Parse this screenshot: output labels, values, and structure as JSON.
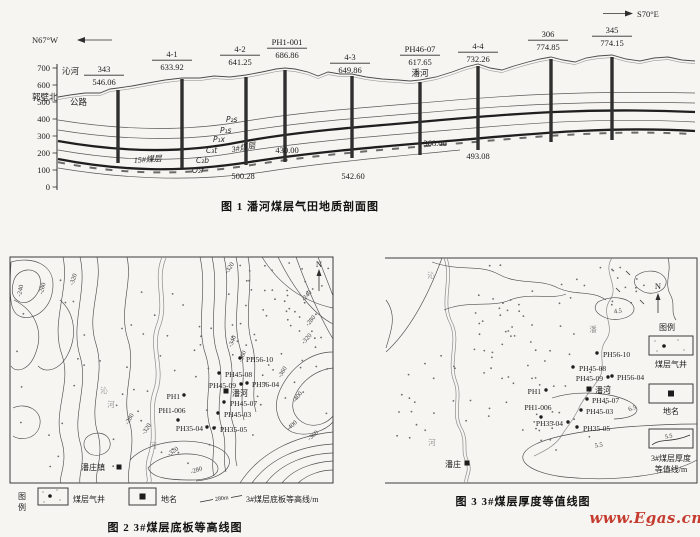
{
  "watermark": {
    "text": "www.Egas.cn",
    "color": "#c53b2f"
  },
  "fig1": {
    "caption": "图 1  潘河煤层气田地质剖面图",
    "dir_left": "N67°W",
    "dir_right": "S70°E",
    "yticks": [
      {
        "t": "700",
        "y": 68
      },
      {
        "t": "600",
        "y": 85
      },
      {
        "t": "500",
        "y": 102
      },
      {
        "t": "400",
        "y": 119
      },
      {
        "t": "300",
        "y": 136
      },
      {
        "t": "200",
        "y": 153
      },
      {
        "t": "100",
        "y": 170
      },
      {
        "t": "0",
        "y": 187
      }
    ],
    "surface_labels": [
      {
        "t": "沁河",
        "x": 62,
        "y": 74
      },
      {
        "t": "郭壁北",
        "x": 32,
        "y": 100
      },
      {
        "t": "公路",
        "x": 70,
        "y": 105
      }
    ],
    "wells": [
      {
        "name": "343",
        "elev": "546.06",
        "x": 118,
        "top": 90,
        "bot": 163,
        "lx": 104,
        "ly": 72
      },
      {
        "name": "4-1",
        "elev": "633.92",
        "x": 182,
        "top": 79,
        "bot": 168,
        "lx": 172,
        "ly": 57
      },
      {
        "name": "4-2",
        "elev": "641.25",
        "x": 246,
        "top": 77,
        "bot": 165,
        "lx": 240,
        "ly": 52
      },
      {
        "name": "PH1-001",
        "elev": "686.86",
        "x": 285,
        "top": 70,
        "bot": 162,
        "lx": 287,
        "ly": 45
      },
      {
        "name": "4-3",
        "elev": "649.86",
        "x": 352,
        "top": 76,
        "bot": 158,
        "lx": 350,
        "ly": 60
      },
      {
        "name": "PH46-07",
        "elev": "617.65",
        "x": 420,
        "top": 82,
        "bot": 155,
        "lx": 420,
        "ly": 52,
        "sub": "潘河"
      },
      {
        "name": "4-4",
        "elev": "732.26",
        "x": 478,
        "top": 66,
        "bot": 150,
        "lx": 478,
        "ly": 49
      },
      {
        "name": "306",
        "elev": "774.85",
        "x": 551,
        "top": 59,
        "bot": 142,
        "lx": 548,
        "ly": 37
      },
      {
        "name": "345",
        "elev": "774.15",
        "x": 612,
        "top": 57,
        "bot": 140,
        "lx": 612,
        "ly": 33
      }
    ],
    "strat_labels": [
      {
        "t": "P₂s",
        "x": 226,
        "y": 122
      },
      {
        "t": "P₁s",
        "x": 220,
        "y": 133
      },
      {
        "t": "P₁x",
        "x": 213,
        "y": 142
      },
      {
        "t": "C₃t",
        "x": 206,
        "y": 153
      },
      {
        "t": "C₂b",
        "x": 196,
        "y": 163
      },
      {
        "t": "O₂f",
        "x": 192,
        "y": 173
      }
    ],
    "coal_labels": [
      {
        "t": "3#煤层",
        "x": 244,
        "y": 150,
        "r": -10
      },
      {
        "t": "15#煤层",
        "x": 148,
        "y": 162,
        "r": -4
      }
    ],
    "depths": [
      {
        "t": "500.28",
        "x": 243,
        "y": 179
      },
      {
        "t": "430.00",
        "x": 287,
        "y": 153
      },
      {
        "t": "542.60",
        "x": 353,
        "y": 179
      },
      {
        "t": "368.00",
        "x": 435,
        "y": 146
      },
      {
        "t": "493.08",
        "x": 478,
        "y": 159
      }
    ]
  },
  "fig2": {
    "caption": "图 2  3#煤层底板等高线图",
    "north": "N",
    "legend": {
      "t1": "图",
      "t2": "例",
      "well": "煤层气井",
      "place": "地名",
      "sym": "280m",
      "contour": "3#煤层底板等高线/m"
    },
    "contour_labels": [
      {
        "t": "-240",
        "x": 22,
        "y": 291,
        "r": -78
      },
      {
        "t": "-280",
        "x": 44,
        "y": 289,
        "r": -75
      },
      {
        "t": "-320",
        "x": 75,
        "y": 280,
        "r": -72
      },
      {
        "t": "-320",
        "x": 231,
        "y": 269,
        "r": -55
      },
      {
        "t": "-240",
        "x": 308,
        "y": 297,
        "r": -48
      },
      {
        "t": "-280",
        "x": 312,
        "y": 322,
        "r": -50
      },
      {
        "t": "-320",
        "x": 308,
        "y": 340,
        "r": -48
      },
      {
        "t": "-340",
        "x": 234,
        "y": 342,
        "r": -68
      },
      {
        "t": "-360",
        "x": 244,
        "y": 357,
        "r": -70
      },
      {
        "t": "-360",
        "x": 284,
        "y": 373,
        "r": -58
      },
      {
        "t": "-400",
        "x": 299,
        "y": 398,
        "r": -52
      },
      {
        "t": "-400",
        "x": 293,
        "y": 427,
        "r": -42
      },
      {
        "t": "-360",
        "x": 314,
        "y": 437,
        "r": -40
      },
      {
        "t": "-320",
        "x": 174,
        "y": 453,
        "r": -35
      },
      {
        "t": "-280",
        "x": 197,
        "y": 472,
        "r": -18
      },
      {
        "t": "-280",
        "x": 131,
        "y": 420,
        "r": -60
      },
      {
        "t": "-320",
        "x": 148,
        "y": 430,
        "r": -55
      }
    ],
    "wells": [
      {
        "name": "PH56-10",
        "dx": 240,
        "dy": 358,
        "lx": 246,
        "ly": 362,
        "a": "start"
      },
      {
        "name": "PH45-08",
        "dx": 219,
        "dy": 373,
        "lx": 225,
        "ly": 377,
        "a": "start"
      },
      {
        "name": "PH45-09",
        "dx": 241,
        "dy": 384,
        "lx": 236,
        "ly": 388,
        "a": "end"
      },
      {
        "name": "PH56-04",
        "dx": 247,
        "dy": 383,
        "lx": 252,
        "ly": 387,
        "a": "start"
      },
      {
        "name": "PH45-07",
        "dx": 224,
        "dy": 402,
        "lx": 230,
        "ly": 406,
        "a": "start"
      },
      {
        "name": "PH45-03",
        "dx": 218,
        "dy": 413,
        "lx": 224,
        "ly": 417,
        "a": "start"
      },
      {
        "name": "PH35-04",
        "dx": 207,
        "dy": 427,
        "lx": 203,
        "ly": 431,
        "a": "end"
      },
      {
        "name": "PH35-05",
        "dx": 214,
        "dy": 428,
        "lx": 220,
        "ly": 432,
        "a": "start"
      },
      {
        "name": "PH1",
        "dx": 184,
        "dy": 395,
        "lx": 180,
        "ly": 399,
        "a": "end"
      },
      {
        "name": "PH1-006",
        "dx": 178,
        "dy": 420,
        "lx": 172,
        "ly": 413,
        "a": "middle"
      }
    ],
    "towns": [
      {
        "t": "潘河",
        "x": 232,
        "y": 396,
        "sq": [
          226,
          391
        ],
        "a": "start"
      },
      {
        "t": "潘庄镇",
        "x": 81,
        "y": 470,
        "sq": [
          119,
          467
        ],
        "a": "start"
      }
    ],
    "river_labels": [
      {
        "t": "沁",
        "x": 104,
        "y": 393
      },
      {
        "t": "河",
        "x": 111,
        "y": 407
      },
      {
        "t": "河",
        "x": 153,
        "y": 448
      }
    ],
    "dot_regions": [
      {
        "x": 225,
        "y": 263,
        "w": 104,
        "h": 92,
        "n": 46
      },
      {
        "x": 100,
        "y": 283,
        "w": 122,
        "h": 185,
        "n": 34
      },
      {
        "x": 16,
        "y": 270,
        "w": 76,
        "h": 200,
        "n": 15
      },
      {
        "x": 248,
        "y": 358,
        "w": 80,
        "h": 78,
        "n": 16
      }
    ]
  },
  "fig3": {
    "caption": "图 3  3#煤层厚度等值线图",
    "north": "N",
    "legend": {
      "title": "图例",
      "well": "煤层气井",
      "place": "地名",
      "sym": "5.5",
      "contour1": "3#煤层厚度",
      "contour2": "等值线/m"
    },
    "contour_labels": [
      {
        "t": "4.5",
        "x": 618,
        "y": 313,
        "r": -5
      },
      {
        "t": "6.5",
        "x": 633,
        "y": 410,
        "r": -20
      },
      {
        "t": "5.5",
        "x": 599,
        "y": 447,
        "r": -8
      }
    ],
    "wells": [
      {
        "name": "PH56-10",
        "dx": 597,
        "dy": 353,
        "lx": 603,
        "ly": 357,
        "a": "start"
      },
      {
        "name": "PH45-08",
        "dx": 573,
        "dy": 367,
        "lx": 579,
        "ly": 371,
        "a": "start"
      },
      {
        "name": "PH45-09",
        "dx": 608,
        "dy": 377,
        "lx": 603,
        "ly": 381,
        "a": "end"
      },
      {
        "name": "PH56-04",
        "dx": 612,
        "dy": 376,
        "lx": 617,
        "ly": 380,
        "a": "start"
      },
      {
        "name": "PH45-07",
        "dx": 587,
        "dy": 399,
        "lx": 592,
        "ly": 403,
        "a": "start"
      },
      {
        "name": "PH45-03",
        "dx": 581,
        "dy": 410,
        "lx": 586,
        "ly": 414,
        "a": "start"
      },
      {
        "name": "PH35-04",
        "dx": 568,
        "dy": 422,
        "lx": 563,
        "ly": 426,
        "a": "end"
      },
      {
        "name": "PH35-05",
        "dx": 577,
        "dy": 427,
        "lx": 583,
        "ly": 431,
        "a": "start"
      },
      {
        "name": "PH1",
        "dx": 546,
        "dy": 390,
        "lx": 541,
        "ly": 394,
        "a": "end"
      },
      {
        "name": "PH1-006",
        "dx": 541,
        "dy": 417,
        "lx": 538,
        "ly": 410,
        "a": "middle"
      }
    ],
    "towns": [
      {
        "t": "潘河",
        "x": 595,
        "y": 393,
        "sq": [
          589,
          389
        ],
        "a": "start"
      },
      {
        "t": "潘庄",
        "x": 461,
        "y": 467,
        "sq": [
          467,
          463
        ],
        "a": "end"
      }
    ],
    "river_labels": [
      {
        "t": "沁",
        "x": 431,
        "y": 278
      },
      {
        "t": "潘",
        "x": 593,
        "y": 332
      },
      {
        "t": "河",
        "x": 432,
        "y": 445
      }
    ],
    "dot_regions": [
      {
        "x": 446,
        "y": 263,
        "w": 188,
        "h": 168,
        "n": 80
      },
      {
        "x": 392,
        "y": 344,
        "w": 52,
        "h": 104,
        "n": 14
      },
      {
        "x": 528,
        "y": 430,
        "w": 62,
        "h": 26,
        "n": 5
      },
      {
        "x": 604,
        "y": 262,
        "w": 50,
        "h": 30,
        "n": 5
      }
    ]
  }
}
